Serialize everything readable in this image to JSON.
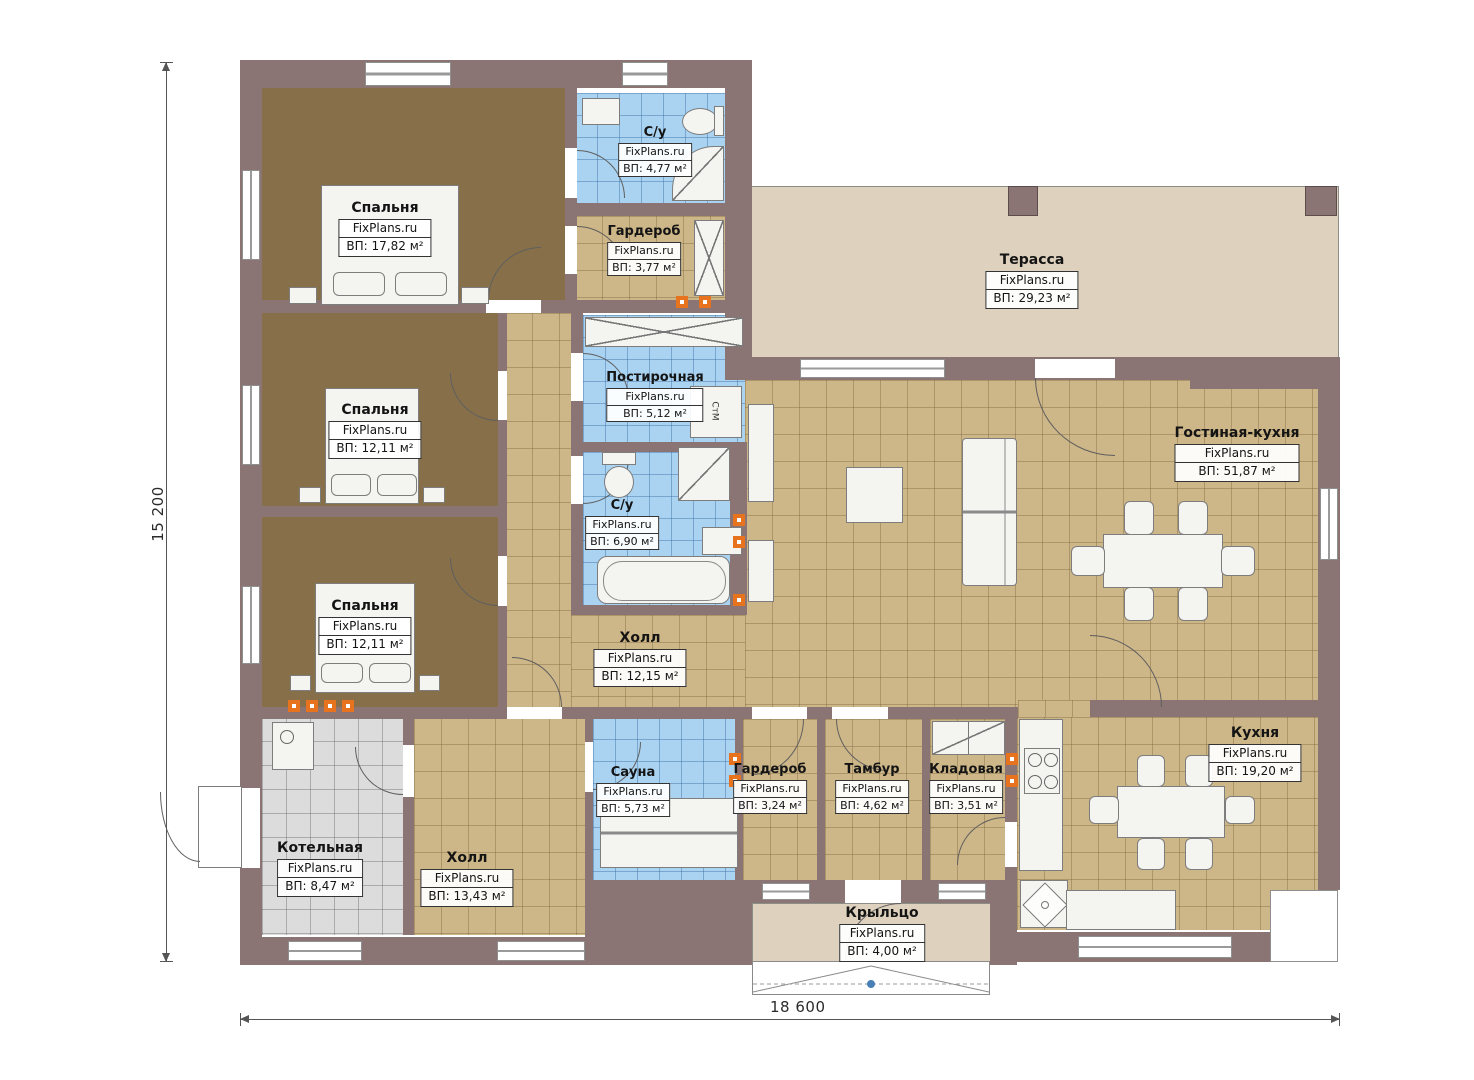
{
  "plan": {
    "brand": "FixPlans.ru",
    "dimensions": {
      "height_mm": "15 200",
      "width_mm": "18 600"
    },
    "fixtures": {
      "washing_machine_label": "СтМ"
    },
    "colors": {
      "wall": "#8b7474",
      "bedroom_floor": "#877049",
      "tile_tan": "#cdb687",
      "tile_blue": "#aad3f1",
      "terrace": "#ded1be",
      "boiler_floor": "#dcdcdc",
      "marker_orange": "#e8731f"
    },
    "rooms": {
      "bedroom_1": {
        "name": "Спальня",
        "brand": "FixPlans.ru",
        "area": "ВП: 17,82 м²"
      },
      "bathroom_1": {
        "name": "С/у",
        "brand": "FixPlans.ru",
        "area": "ВП: 4,77 м²"
      },
      "wardrobe_1": {
        "name": "Гардероб",
        "brand": "FixPlans.ru",
        "area": "ВП: 3,77 м²"
      },
      "terrace": {
        "name": "Терасса",
        "brand": "FixPlans.ru",
        "area": "ВП: 29,23 м²"
      },
      "bedroom_2": {
        "name": "Спальня",
        "brand": "FixPlans.ru",
        "area": "ВП: 12,11 м²"
      },
      "laundry": {
        "name": "Постирочная",
        "brand": "FixPlans.ru",
        "area": "ВП: 5,12 м²"
      },
      "bathroom_2": {
        "name": "С/у",
        "brand": "FixPlans.ru",
        "area": "ВП: 6,90 м²"
      },
      "living_kitchen": {
        "name": "Гостиная-кухня",
        "brand": "FixPlans.ru",
        "area": "ВП: 51,87 м²"
      },
      "bedroom_3": {
        "name": "Спальня",
        "brand": "FixPlans.ru",
        "area": "ВП: 12,11 м²"
      },
      "hall_1": {
        "name": "Холл",
        "brand": "FixPlans.ru",
        "area": "ВП: 12,15 м²"
      },
      "boiler": {
        "name": "Котельная",
        "brand": "FixPlans.ru",
        "area": "ВП: 8,47 м²"
      },
      "hall_2": {
        "name": "Холл",
        "brand": "FixPlans.ru",
        "area": "ВП: 13,43 м²"
      },
      "sauna": {
        "name": "Сауна",
        "brand": "FixPlans.ru",
        "area": "ВП: 5,73 м²"
      },
      "wardrobe_2": {
        "name": "Гардероб",
        "brand": "FixPlans.ru",
        "area": "ВП: 3,24 м²"
      },
      "vestibule": {
        "name": "Тамбур",
        "brand": "FixPlans.ru",
        "area": "ВП: 4,62 м²"
      },
      "storage": {
        "name": "Кладовая",
        "brand": "FixPlans.ru",
        "area": "ВП: 3,51 м²"
      },
      "kitchen": {
        "name": "Кухня",
        "brand": "FixPlans.ru",
        "area": "ВП: 19,20 м²"
      },
      "porch": {
        "name": "Крыльцо",
        "brand": "FixPlans.ru",
        "area": "ВП: 4,00 м²"
      }
    }
  }
}
